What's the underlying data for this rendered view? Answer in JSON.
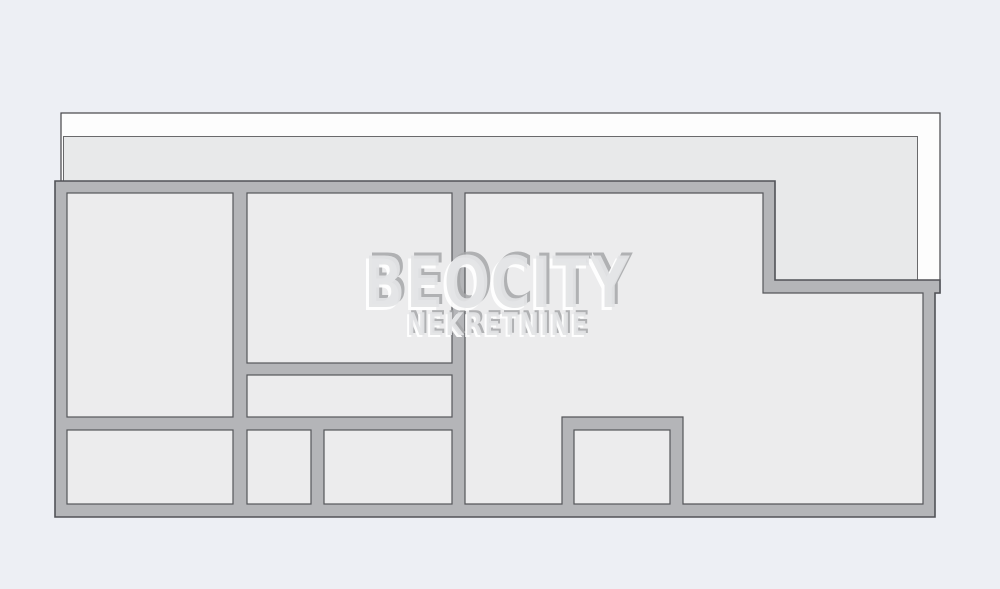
{
  "watermark": {
    "brand": "BEOCITY",
    "subtitle": "NEKRETNINE"
  },
  "colors": {
    "background": "#edeff4",
    "balcony_band": "#fdfdfd",
    "terrace": "#e8e9ea",
    "walls": "#b4b5b8",
    "rooms": "#ececed",
    "watermark_face": "#e3e4e6",
    "watermark_highlight": "#ffffff",
    "watermark_shadow": "#a6a7a9"
  }
}
